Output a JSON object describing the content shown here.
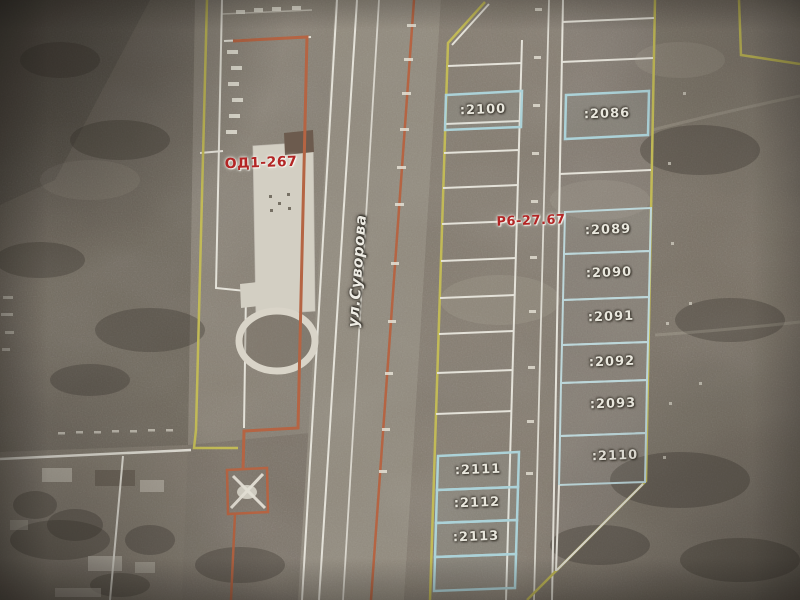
{
  "map": {
    "street": {
      "label": "ул.Суворова"
    },
    "zones": [
      {
        "code": "ОД1-267"
      },
      {
        "code": "Р6-27.67"
      }
    ],
    "parcels": [
      {
        "id": "2100",
        "label": ":2100"
      },
      {
        "id": "2086",
        "label": ":2086"
      },
      {
        "id": "2089",
        "label": ":2089"
      },
      {
        "id": "2090",
        "label": ":2090"
      },
      {
        "id": "2091",
        "label": ":2091"
      },
      {
        "id": "2092",
        "label": ":2092"
      },
      {
        "id": "2093",
        "label": ":2093"
      },
      {
        "id": "2110",
        "label": ":2110"
      },
      {
        "id": "2111",
        "label": ":2111"
      },
      {
        "id": "2112",
        "label": ":2112"
      },
      {
        "id": "2113",
        "label": ":2113"
      }
    ],
    "colors": {
      "boundary_yellow": "#c6bd48",
      "boundary_white": "#e8e5da",
      "parcel_highlight_cyan": "#a9d6dd",
      "boundary_orange": "#c0613a",
      "zone_label_red": "#c41e1e"
    }
  }
}
